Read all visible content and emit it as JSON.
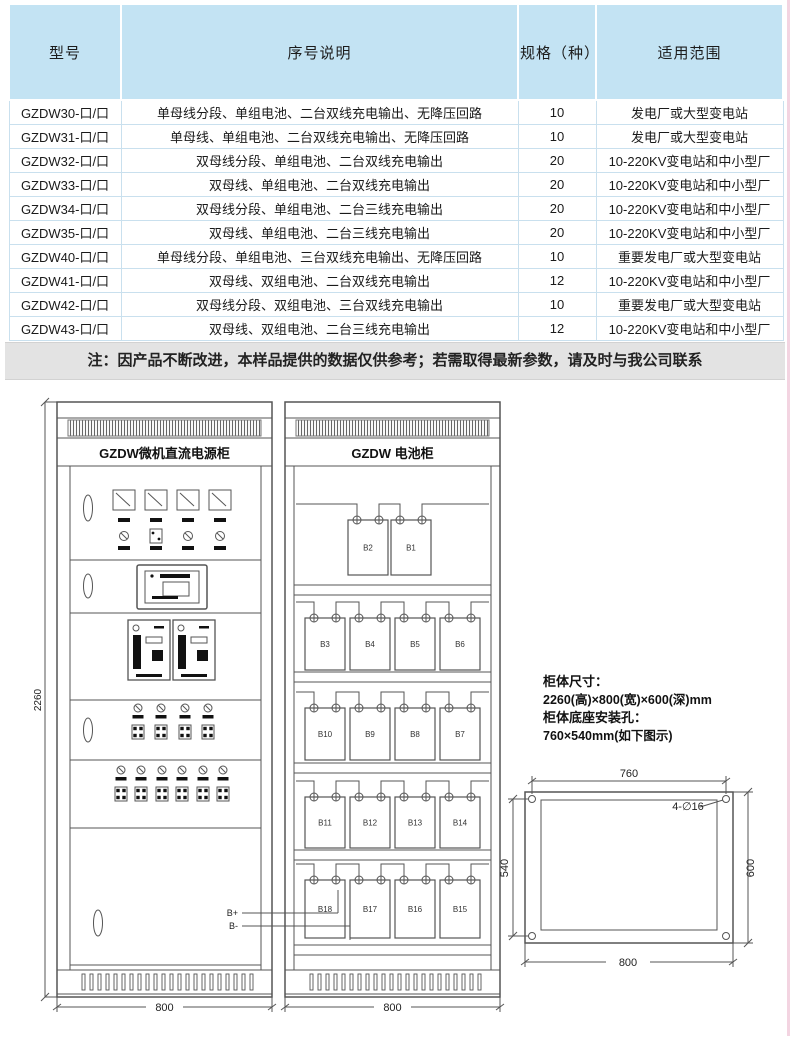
{
  "table": {
    "headers": [
      "型号",
      "序号说明",
      "规格（种）",
      "适用范围"
    ],
    "rows": [
      [
        "GZDW30-口/口",
        "单母线分段、单组电池、二台双线充电输出、无降压回路",
        "10",
        "发电厂或大型变电站"
      ],
      [
        "GZDW31-口/口",
        "单母线、单组电池、二台双线充电输出、无降压回路",
        "10",
        "发电厂或大型变电站"
      ],
      [
        "GZDW32-口/口",
        "双母线分段、单组电池、二台双线充电输出",
        "20",
        "10-220KV变电站和中小型厂"
      ],
      [
        "GZDW33-口/口",
        "双母线、单组电池、二台双线充电输出",
        "20",
        "10-220KV变电站和中小型厂"
      ],
      [
        "GZDW34-口/口",
        "双母线分段、单组电池、二台三线充电输出",
        "20",
        "10-220KV变电站和中小型厂"
      ],
      [
        "GZDW35-口/口",
        "双母线、单组电池、二台三线充电输出",
        "20",
        "10-220KV变电站和中小型厂"
      ],
      [
        "GZDW40-口/口",
        "单母线分段、单组电池、三台双线充电输出、无降压回路",
        "10",
        "重要发电厂或大型变电站"
      ],
      [
        "GZDW41-口/口",
        "双母线、双组电池、二台双线充电输出",
        "12",
        "10-220KV变电站和中小型厂"
      ],
      [
        "GZDW42-口/口",
        "双母线分段、双组电池、三台双线充电输出",
        "10",
        "重要发电厂或大型变电站"
      ],
      [
        "GZDW43-口/口",
        "双母线、双组电池、二台三线充电输出",
        "12",
        "10-220KV变电站和中小型厂"
      ]
    ]
  },
  "note": "注：因产品不断改进，本样品提供的数据仅供参考；若需取得最新参数，请及时与我公司联系",
  "drawing": {
    "dc_cabinet": {
      "title": "GZDW微机直流电源柜",
      "width_label": "800",
      "height_label": "2260",
      "bplus_label": "B+",
      "bminus_label": "B-"
    },
    "battery_cabinet": {
      "title": "GZDW 电池柜",
      "width_label": "800",
      "battery_rows": [
        [
          "B2",
          "B1"
        ],
        [
          "B3",
          "B4",
          "B5",
          "B6"
        ],
        [
          "B10",
          "B9",
          "B8",
          "B7"
        ],
        [
          "B11",
          "B12",
          "B13",
          "B14"
        ],
        [
          "B18",
          "B17",
          "B16",
          "B15"
        ]
      ]
    },
    "specs": {
      "size_label": "柜体尺寸：",
      "size_value": "2260(高)×800(宽)×600(深)mm",
      "holes_label": "柜体底座安装孔：",
      "holes_value": "760×540mm(如下图示)"
    },
    "mounting": {
      "top": "760",
      "bottom": "800",
      "left": "540",
      "right": "600",
      "holes_note": "4-∅16"
    }
  },
  "colors": {
    "table_header_bg": "#c3e3f3",
    "note_bg": "#e3e3e3",
    "line": "#555555",
    "page_right_edge": "#f3d4e1"
  }
}
